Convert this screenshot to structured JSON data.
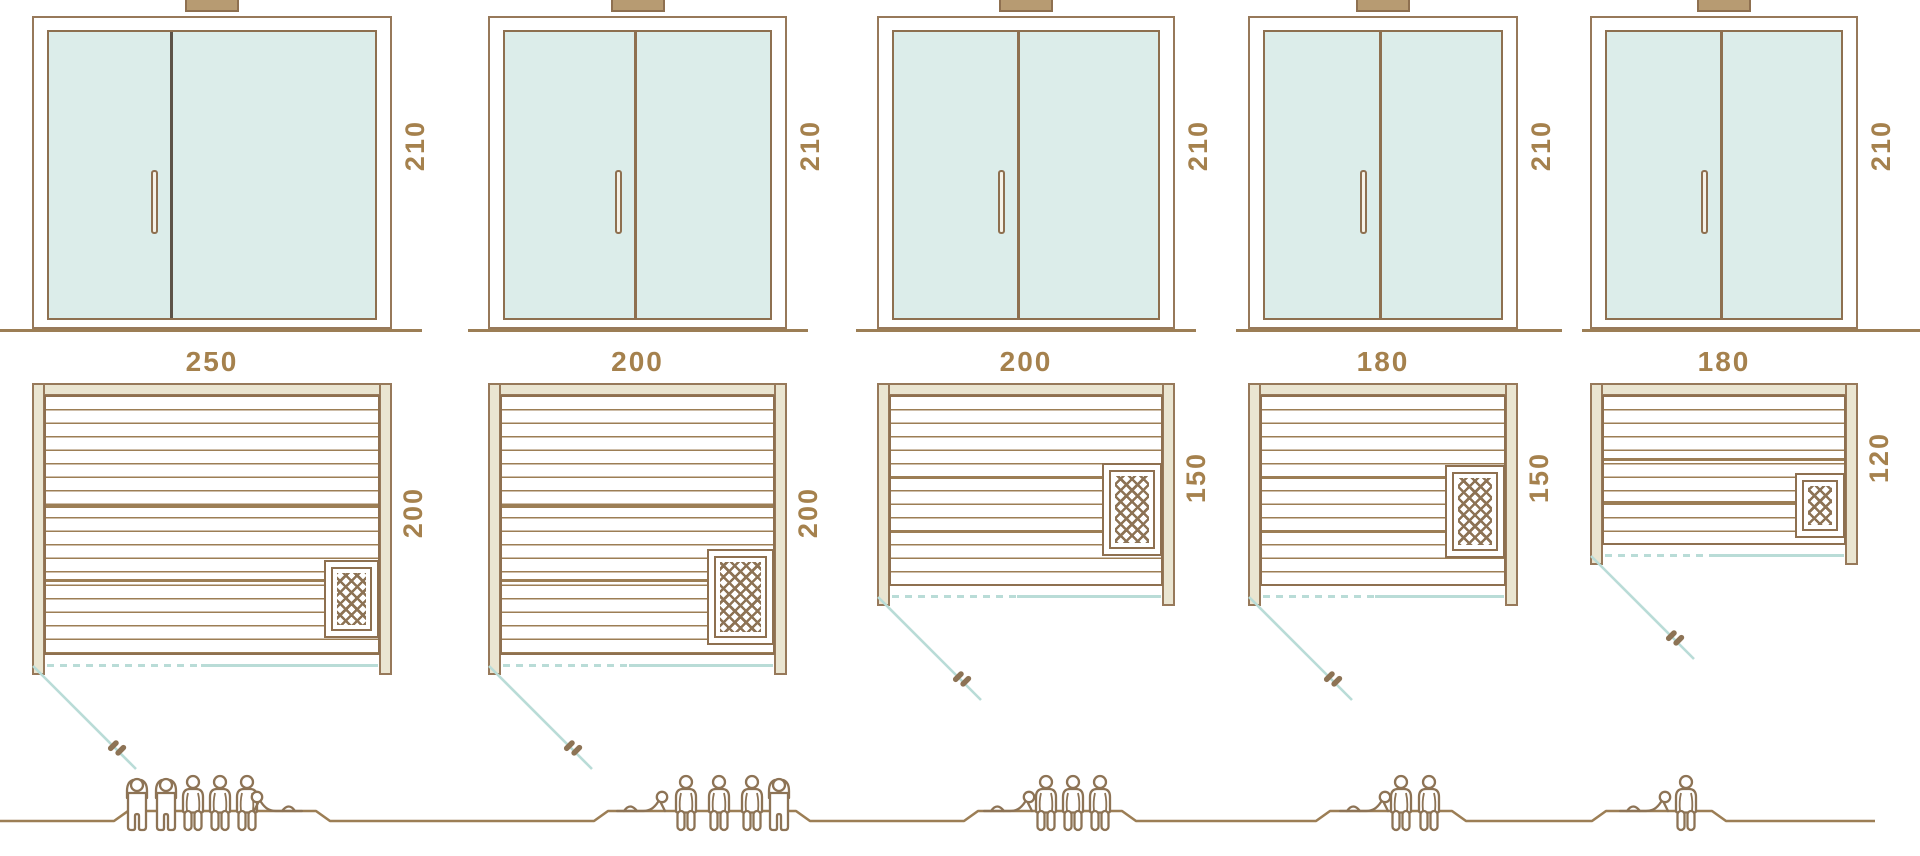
{
  "diagram_type": "sauna-size-comparison",
  "colors": {
    "line_brown": "#8e7050",
    "light_brown": "#9c7e55",
    "label_brown": "#a5814d",
    "wall_beige": "#eae5d1",
    "glass_teal": "#dcedea",
    "teal_line": "#b9dcd7",
    "vent_fill": "#b79b72",
    "background": "#ffffff"
  },
  "units": [
    {
      "door_height": "210",
      "plan_width": "250",
      "plan_depth": "200",
      "capacity": 6,
      "figures": [
        "standing",
        "standing",
        "seated",
        "seated",
        "seated",
        "lying"
      ]
    },
    {
      "door_height": "210",
      "plan_width": "200",
      "plan_depth": "200",
      "capacity": 5,
      "figures": [
        "lying",
        "seated",
        "seated",
        "seated",
        "standing"
      ]
    },
    {
      "door_height": "210",
      "plan_width": "200",
      "plan_depth": "150",
      "capacity": 4,
      "figures": [
        "lying",
        "seated",
        "seated",
        "seated"
      ]
    },
    {
      "door_height": "210",
      "plan_width": "180",
      "plan_depth": "150",
      "capacity": 3,
      "figures": [
        "lying",
        "seated",
        "seated"
      ]
    },
    {
      "door_height": "210",
      "plan_width": "180",
      "plan_depth": "120",
      "capacity": 2,
      "figures": [
        "lying",
        "seated"
      ]
    }
  ]
}
